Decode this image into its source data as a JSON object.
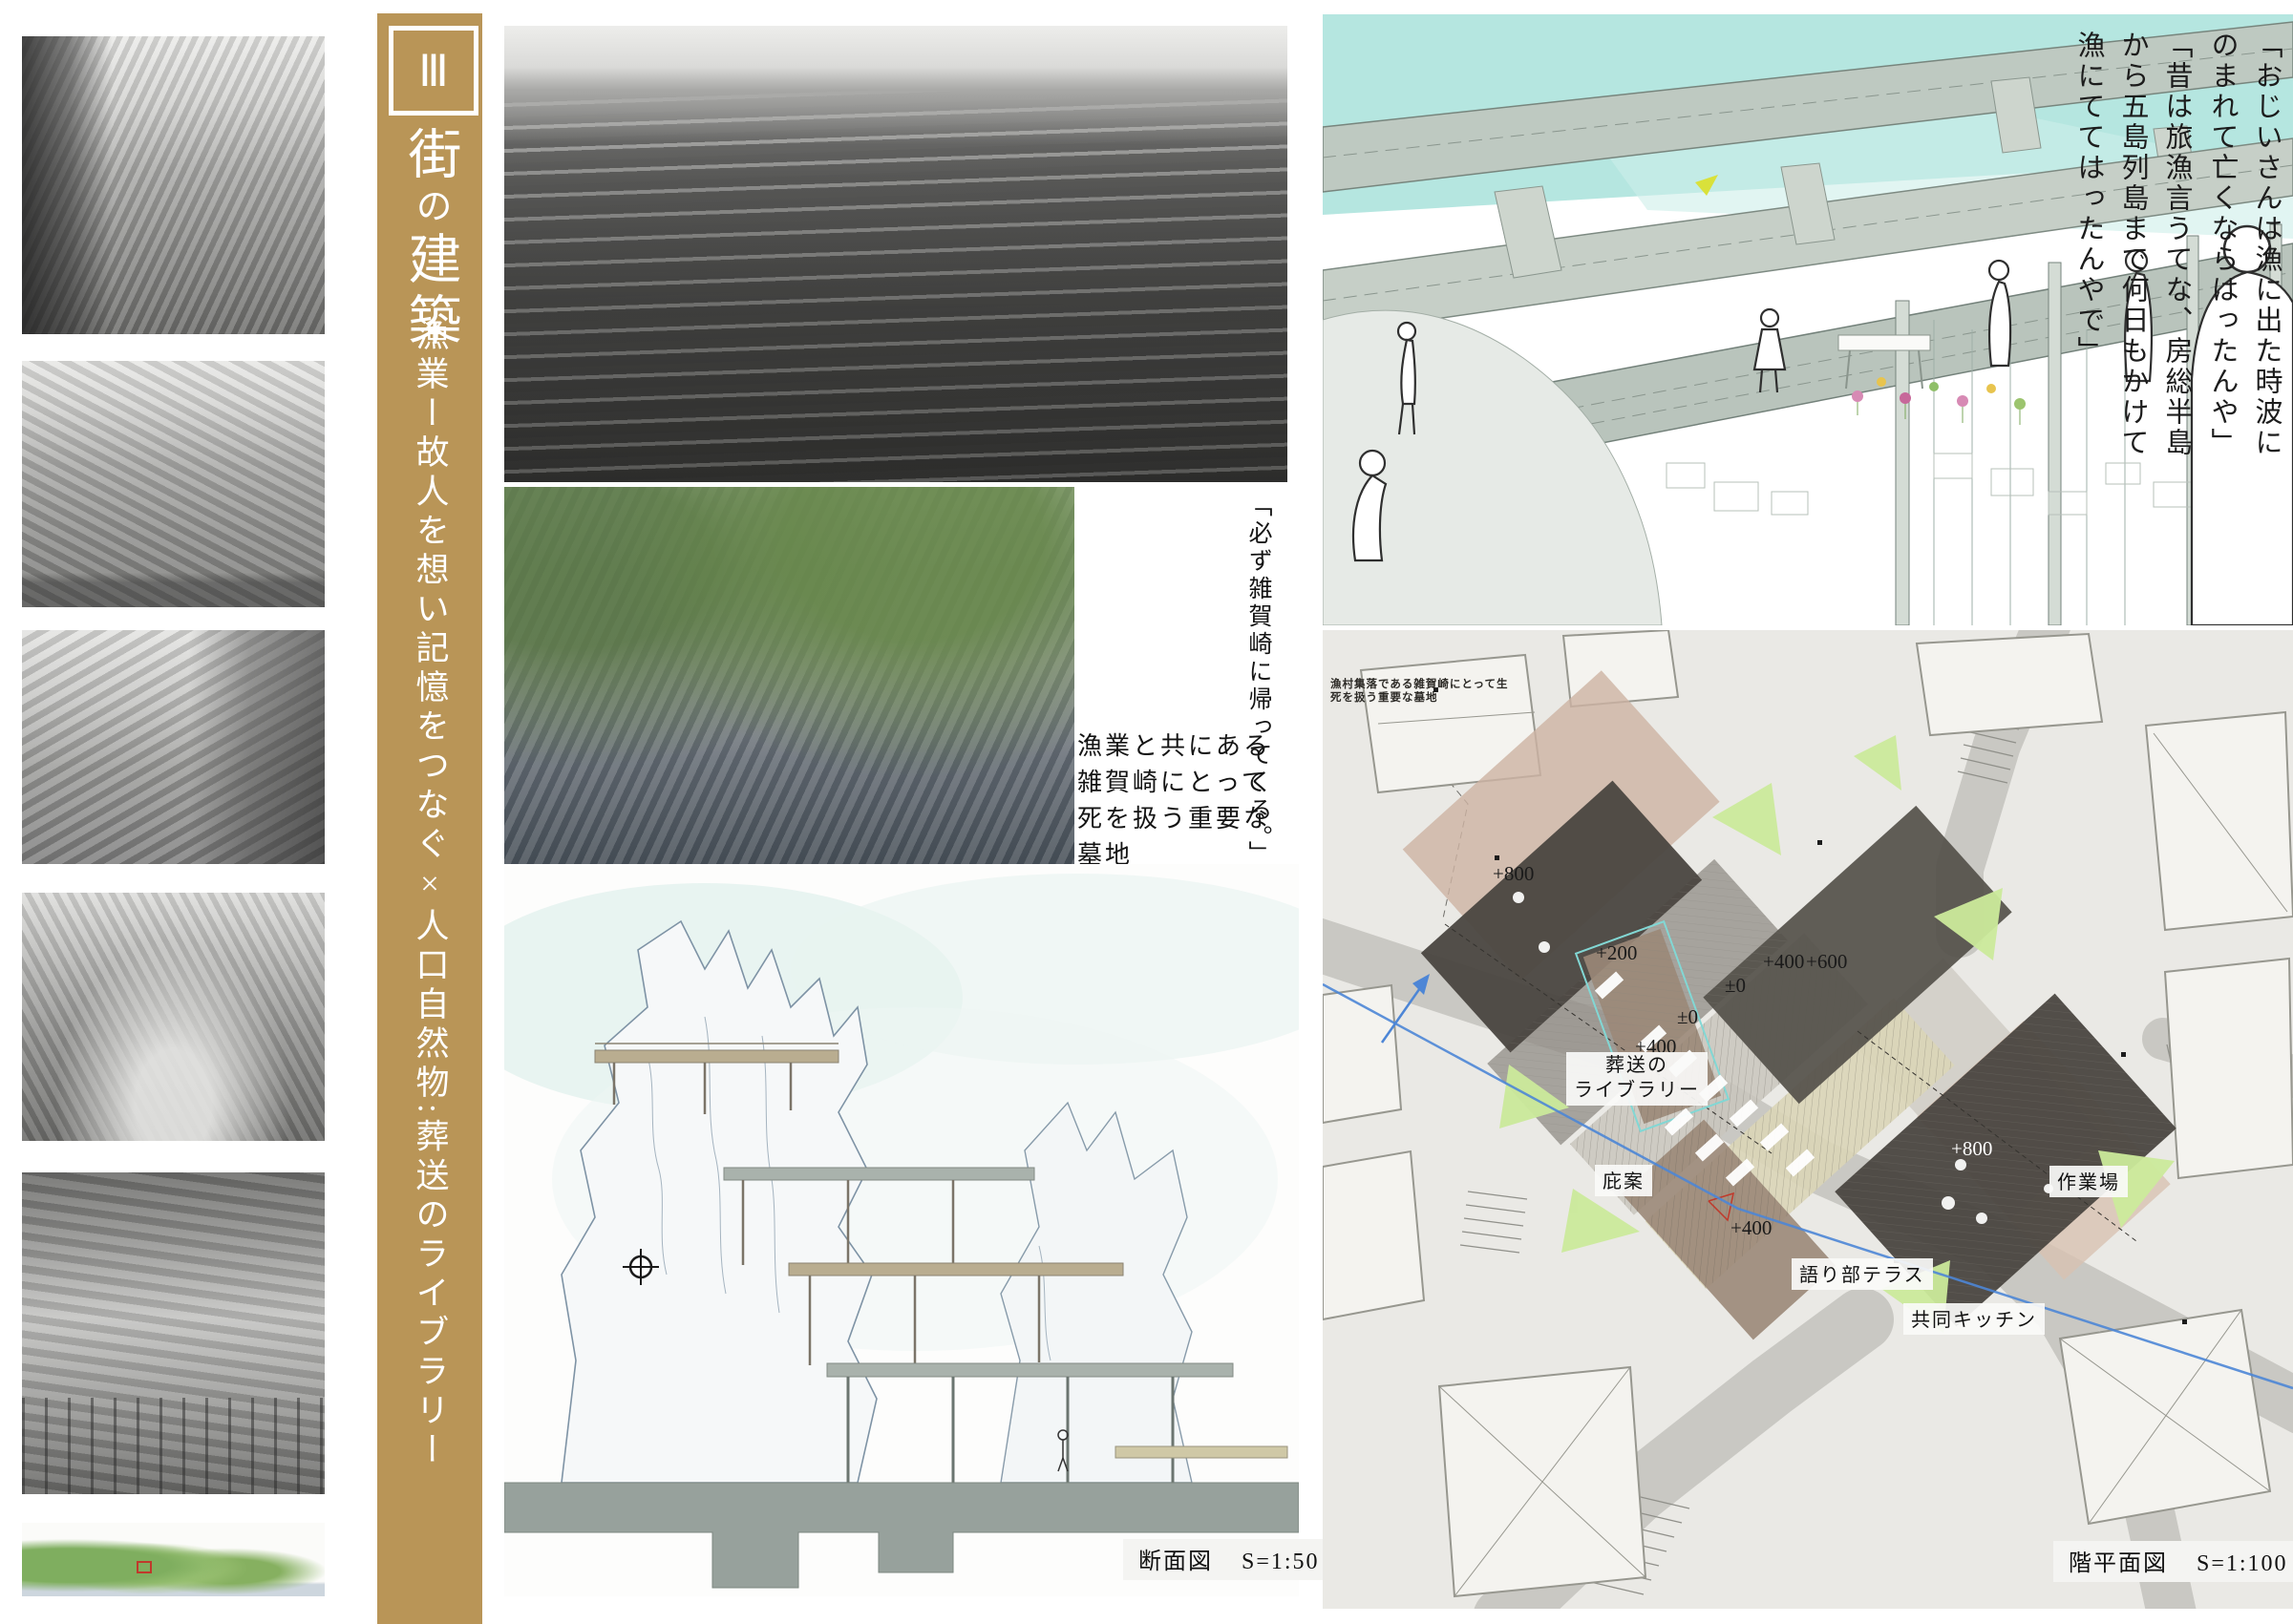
{
  "banner": {
    "numeral": "Ⅲ",
    "title": "街の建築",
    "title_parts": [
      "街",
      "の",
      "建築"
    ],
    "subtitle": "漁業ー故人を想い記憶をつなぐ×人口自然物:葬送のライブラリー"
  },
  "middle": {
    "return_quote": "「必ず雑賀崎に帰ってくる。」",
    "cemetery_caption": [
      "漁業と共にある",
      "雑賀崎にとって",
      "死を扱う重要な",
      "墓地"
    ],
    "section": {
      "label": "断面図",
      "scale": "S=1:50"
    }
  },
  "render": {
    "quote1_lines": [
      "「おじいさんは漁に出た時波に",
      "のまれて亡くならはったんや」"
    ],
    "quote2_lines": [
      "「昔は旅漁言うてな、房総半島",
      "から五島列島まで何日もかけて",
      "漁にててはったんやで」"
    ]
  },
  "plan": {
    "annotation_lines": [
      "漁村集落である雑賀崎にとって生",
      "死を扱う重要な墓地"
    ],
    "labels": {
      "library_line1": "葬送の",
      "library_line2": "ライブラリー",
      "hisashi": "庇案",
      "terrace": "語り部テラス",
      "kitchen": "共同キッチン",
      "workshop": "作業場"
    },
    "elevations": {
      "e800": "+800",
      "e200": "+200",
      "e0a": "±0",
      "e0b": "±0",
      "e400_upper": "+400",
      "e400_right": "+400",
      "e400_lower": "+400",
      "e600": "+600",
      "e800_white": "+800"
    },
    "figure": {
      "label": "階平面図",
      "scale": "S=1:100"
    }
  },
  "colors": {
    "banner_gold": "#b99557",
    "plan_dark": "#4a4640",
    "plan_green": "#cbea9b",
    "blue_line": "#4d86d6",
    "sky_teal": "#a8e2da"
  }
}
